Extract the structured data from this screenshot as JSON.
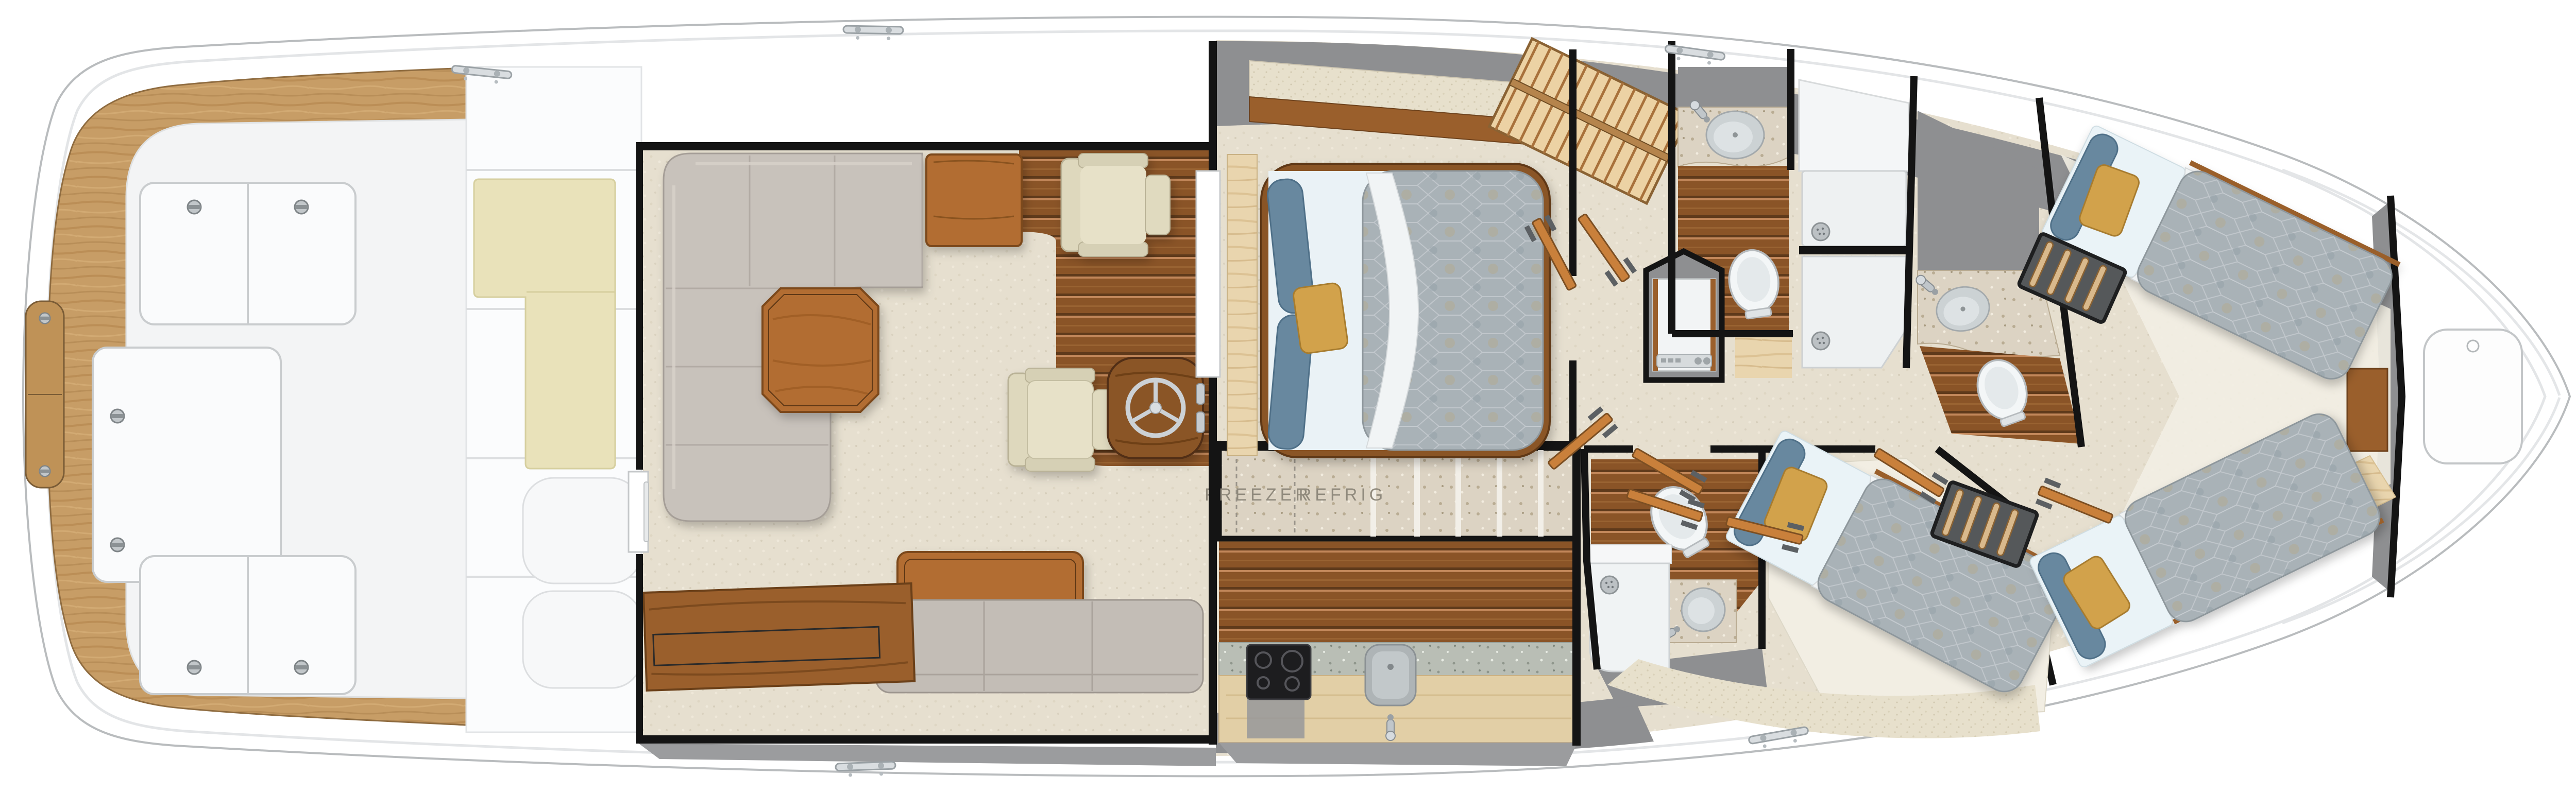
{
  "diagram": {
    "kind": "yacht-interior-floor-plan",
    "labels": {
      "freezer": "FREEZER",
      "refrig": "REFRIG"
    }
  },
  "colors": {
    "hull_white": "#ffffff",
    "hull_outline": "#b9bcbe",
    "teak": "#c79d66",
    "cockpit_floor": "#f3f4f5",
    "mezzanine_cushion": "#e9e2ba",
    "carpet": "#e6dfcf",
    "sofa_gray": "#c8c2bb",
    "chair_cream": "#ded8bd",
    "table_wood": "#b26d30",
    "plank_floor": "#8a5427",
    "counter_speckle": "#dcd3c3",
    "granite": "#b9beb5",
    "cabinet_beige": "#e2cfa6",
    "quilt": "#a9b2b7",
    "pillow_blue": "#67889f",
    "pillow_gold": "#d2a24b",
    "maple": "#e9d5ae",
    "wall_black": "#141414",
    "void_gray": "#8e8f91",
    "door_wood": "#c9803b",
    "label_text": "#8f897c"
  },
  "icons": {
    "cleat": "═",
    "hatch_latch": "◉",
    "shower_drain": "⊙",
    "steering_wheel": "☸",
    "faucet": "⌐"
  }
}
